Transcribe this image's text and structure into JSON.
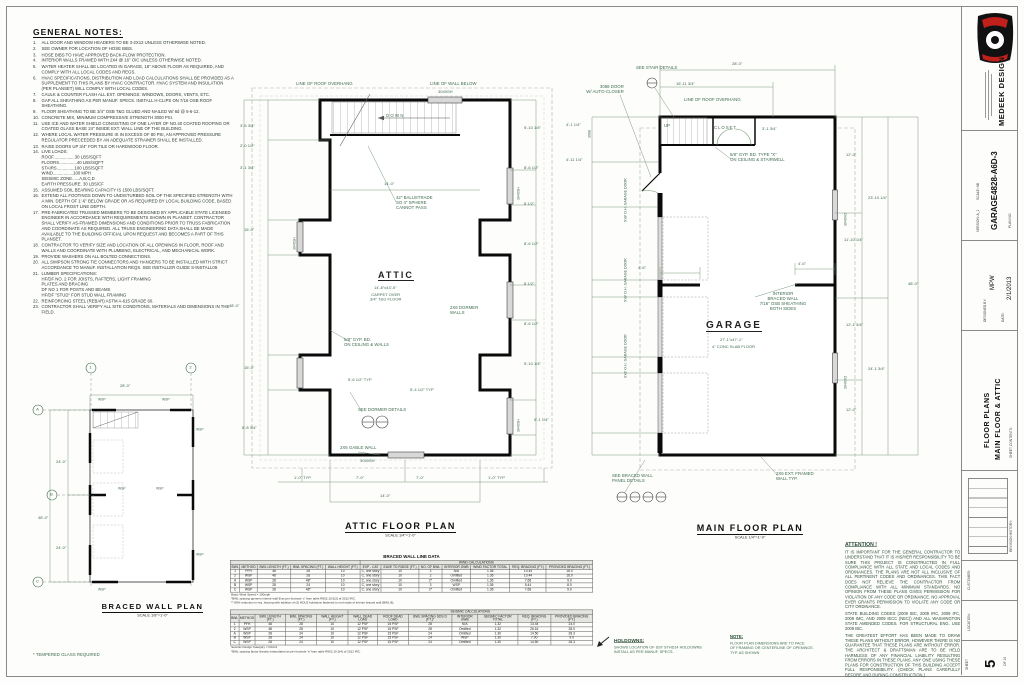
{
  "colors": {
    "annotation": "#3e6b4e",
    "wall": "#0a0a0a",
    "accent_red": "#c0201c",
    "sheet": "#fdfdfc"
  },
  "general_notes": {
    "title": "GENERAL NOTES:",
    "items": [
      {
        "n": "1.",
        "t": "ALL DOOR AND WINDOW HEADERS TO BE 3-2X12 UNLESS OTHERWISE NOTED."
      },
      {
        "n": "2.",
        "t": "SEE OWNER FOR LOCATION OF HOSE BIBS."
      },
      {
        "n": "3.",
        "t": "HOSE BIBS TO HAVE APPROVED BACK-FLOW PROTECTION."
      },
      {
        "n": "4.",
        "t": "INTERIOR WALLS FRAMED WITH 2X4 @ 16\" O/C UNLESS OTHERWISE NOTED."
      },
      {
        "n": "5.",
        "t": "WATER HEATER SHALL BE LOCATED IN GARAGE, 18\" ABOVE FLOOR AS REQUIRED, AND COMPLY WITH ALL LOCAL CODES AND REGS."
      },
      {
        "n": "6.",
        "t": "HVAC SPECIFICATIONS, DISTRIBUTION AND LOAD CALCULATIONS SHALL BE PROVIDED AS A SUPPLEMENT TO THIS PLANS BY HVAC CONTRACTOR. HVAC SYSTEM AND INSULATION (PER PLANSET) WILL COMPLY WITH LOCAL CODES."
      },
      {
        "n": "7.",
        "t": "CAULK & COUNTER FLASH ALL EXT. OPENINGS: WINDOWS, DOORS, VENTS, ETC."
      },
      {
        "n": "8.",
        "t": "GAP ALL SHEATHING AS PER MANUF. SPECS.  INSTALL H-CLIPS ON 7/16 OSB ROOF SHEATHING."
      },
      {
        "n": "9.",
        "t": "FLOOR SHEATHING TO BE 3/4\" OSB T&G GLUED AND NAILED W/ 8d @ 6-6-12."
      },
      {
        "n": "10.",
        "t": "CONCRETE MIX, MINIMUM COMPRESSIVE STRENGTH 3000 PSI."
      },
      {
        "n": "11.",
        "t": "USE ICE AND WATER SHIELD CONSISTING OF ONE LAYER OF NO.40 COATED ROOFING OR COATED GLASS BASE 24\" INSIDE EXT. WALL LINE OF THE BUILDING."
      },
      {
        "n": "12.",
        "t": "WHERE LOCAL WATER PRESSURE IS IN EXCESS OF 80 PSI, AN APPROVED PRESSURE REGULATOR PRECEEDED BY AN ADEQUATE STRAINER SHALL BE INSTALLED."
      },
      {
        "n": "13.",
        "t": "RAISE DOORS UP 3/4\" FOR TILE OR HARDWOOD FLOOR."
      },
      {
        "n": "14.",
        "t": "LIVE LOADS:\nROOF..................30 LBS/SQFT\nFLOORS...............40 LBS/SQFT\nSTAIRS...............100 LBS/SQFT\nWIND.................100 MPH\nSEISMIC ZONE......A,B,C,D\nEARTH PRESSURE. 30 LBS/CF"
      },
      {
        "n": "15.",
        "t": "ASSUMED SOIL BEARING CAPACITY IS 1500 LBS/SQFT."
      },
      {
        "n": "16.",
        "t": "EXTEND ALL FOOTINGS DOWN TO UNDISTURBED SOIL OF THE SPECIFIED STRENGTH WITH A MIN. DEPTH OF 1'-6\" BELOW GRADE OR AS REQUIRED BY LOCAL BUILDING CODE, BASED ON LOCAL FROST LINE DEPTH."
      },
      {
        "n": "17.",
        "t": "PRE-FABRICATED TRUSSED MEMBERS TO BE DESIGNED BY APPLICABLE STATE LICENSED ENGINEER IN ACCORDANCE WITH REQUIREMENTS SHOWN IN PLANSET. CONTRACTOR SHALL VERIFY AS-FRAMED DIMENSIONS AND CONDITIONS PRIOR TO TRUSS FABRICATION AND COORDINATE AS REQUIRED.  ALL TRUSS ENGINEERING DATA SHALL BE MADE AVAILABLE TO THE BUILDING OFFICIAL UPON REQUEST AND BECOMES A PART OF THIS PLANSET."
      },
      {
        "n": "18.",
        "t": "CONTRACTOR TO VERIFY SIZE AND LOCATION OF ALL OPENINGS IN FLOOR, ROOF AND WALLS AND COORDINATE WITH PLUMBING, ELECTRICAL, AND MECHANICAL WORK."
      },
      {
        "n": "19.",
        "t": "PROVIDE WASHERS ON ALL BOLTED CONNECTIONS."
      },
      {
        "n": "20.",
        "t": "ALL SIMPSON STRONG TIE CONNECTORS AND HANGERS TO BE INSTALLED WITH STRICT ACCORDANCE TO MANUF. INSTALLATION REQS. SEE INSTALLER GUIDE S-INSTALL09."
      },
      {
        "n": "21.",
        "t": "LUMBER SPECIFICATIONS:\nHF/DF NO. 2 FOR JOISTS, RAFTERS, LIGHT FRAMING\nPLATES AND BRACING\nDF NO 1 FOR POSTS AND BEAMS\nHF/DF \"STUD\" FOR STUD WALL FRAMING"
      },
      {
        "n": "22.",
        "t": "REINFORCING STEEL (REBAR) ASTM A-615 GRADE 60."
      },
      {
        "n": "23.",
        "t": "CONTRACTOR SHALL VERIFY ALL SITE CONDITIONS, MATERIALS AND DIMENSIONS IN THE FIELD."
      }
    ]
  },
  "attic": {
    "title": "ATTIC FLOOR PLAN",
    "scale": "SCALE 1/4\"=1'-0\"",
    "room": "ATTIC",
    "room_size": "14'-8\"x43'-5\"",
    "room_floor": "CARPET OVER\n3/4\" T&G FLOOR",
    "down": "DOWN",
    "balustrade": "42\" BALUSTRADE\nSO 4\" SPHERE\nCANNOT PASS",
    "roof_overhang": "LINE OF ROOF OVERHANG",
    "wall_below": "LINE OF WALL BELOW",
    "dormer_walls": "2X6 DORMER\nWALLS",
    "gyp": "5/8\" GYP. BD.\nON CEILING & WALLS",
    "gable": "2X6 GABLE WALL",
    "see_dormer": "SEE DORMER DETAILS",
    "win": "3040SH",
    "dim_top": "14'-0\"",
    "dims_left": [
      "3'-5 3/4\"",
      "2'-0 1/2\"",
      "3'-1 3/4\"",
      "15'-0\"",
      "15'-0\"",
      "8'-8 3/4\""
    ],
    "dim_left_total": "48'-0\"",
    "dims_right": [
      "5'-10 1/4\"",
      "8'-6 1/2\"",
      "8 1/2\"",
      "8'-6 1/2\"",
      "8 1/2\"",
      "8'-6 1/2\"",
      "5'-10 1/4\""
    ],
    "dim_right_extra": "5'-1 1/4\"",
    "typ1": "5'-6 1/2\" TYP",
    "typ2": "5'-4 1/2\" TYP",
    "dims_bottom": [
      "1'-0\" TYP",
      "7'-0\"",
      "7'-0\"",
      "1'-0\" TYP"
    ],
    "dim_bottom_total": "14'-0\""
  },
  "main": {
    "title": "MAIN FLOOR PLAN",
    "scale": "SCALE 1/4\"=1'-0\"",
    "room": "GARAGE",
    "room_size": "27'-1\"x47'-1\"",
    "room_floor": "4\" CONC SLAB FLOOR",
    "up": "UP",
    "closet": "CLOSET",
    "door": "3068 DOOR\nW/ AUTO-CLOSER",
    "door_tag": "3068",
    "see_stair": "SEE STAIR DETAILS",
    "roof_overhang": "LINE OF ROOF OVERHANG",
    "gyp": "5/8\" GYP. BD. TYPE \"X\"\nON CEILING & STAIRWELL",
    "braced": "INTERIOR\nBRACED WALL\n7/16\" OSB SHEATHING\nBOTH SIDES",
    "garage_door": "9'x8' O.H. GARAGE DOOR",
    "ext_wall": "2X6 EXT. FRAMED\nWALL TYP.",
    "see_braced": "SEE BRACED WALL\nPANEL DETAILS",
    "win": "3040XO",
    "dim_top": "28'-0\"",
    "dim_top2": "16'-11 3/4\"",
    "dim_closet": "3'-1 3/4\"",
    "dim_stub": "4'-6\"",
    "dims_left": [
      "4'-1 1/4\"",
      "4'-11 1/4\""
    ],
    "dims_right": [
      "12'-0\"",
      "23'-10 1/4\"",
      "11'-10 1/4\"",
      "48'-0\"",
      "12'-1 3/4\"",
      "24'-1 3/4\"",
      "12'-0\""
    ]
  },
  "braced": {
    "title": "BRACED WALL PLAN",
    "scale": "SCALE 1/8\"=1'-0\"",
    "footnote": "* TEMPERED GLASS REQUIRED",
    "grid_cols": [
      "1",
      "2"
    ],
    "grid_rows": [
      "A",
      "B",
      "C"
    ],
    "dim_top": "28'-0\"",
    "dims_left": [
      "24'-0\"",
      "24'-0\""
    ],
    "dim_left_total": "48'-0\"",
    "wsp": "WSP"
  },
  "tables": {
    "title": "BRACED WALL LINE DATA",
    "wind": {
      "header": "WIND CALCULATIONS",
      "columns": [
        "BWL",
        "METHOD",
        "BWL LENGTH (FT.)",
        "BWL SPACING (FT.)",
        "WALL HEIGHT (FT.)",
        "EXP - CAT",
        "EAVE TO RIDGE (FT.)",
        "NO. OF BWL",
        "INTERIOR GWB",
        "WIND FACTOR TOTAL",
        "REQ. BRACING (FT.)",
        "PROVIDED BRACING (FT.)"
      ],
      "rows": [
        [
          "1",
          "PFH",
          "48",
          "28",
          "10",
          "C, one story",
          "10",
          "2",
          "N/A",
          "1.36",
          "10.44",
          "16.0"
        ],
        [
          "2",
          "WSP",
          "48",
          "28",
          "10",
          "C, one story",
          "10",
          "2",
          "Omitted",
          "1.36",
          "10.44",
          "16.0"
        ],
        [
          "A",
          "WSP",
          "28",
          "48*",
          "10",
          "C, one story",
          "10",
          "2*",
          "Omitted",
          "1.36",
          "7.68",
          "9.0"
        ],
        [
          "B",
          "WSP",
          "28",
          "24",
          "10",
          "C, one story",
          "10",
          "3",
          "WSP",
          "1.36",
          "5.44",
          "8.0"
        ],
        [
          "C",
          "WSP",
          "28",
          "48*",
          "10",
          "C, one story",
          "10",
          "2*",
          "Omitted",
          "1.36",
          "7.68",
          "9.0"
        ]
      ],
      "footnotes": [
        "Basic Wind Speed = 100mph",
        "*BWL spacing governs interior wall B as per footnote 'c' from table R602.10.5(2) of 2012 IRC.",
        "** 80% reduction in req. bracing with addition of (2) HDU2 holdowns fastened to end studs of interior braced wall (BWL B)."
      ]
    },
    "seismic": {
      "header": "SEISMIC CALCULATIONS",
      "columns": [
        "BWL",
        "METHOD",
        "BWL LENGTH (FT.)",
        "BWL SPACING (FT.)",
        "WALL HEIGHT (FT.)",
        "WALL DEAD LOAD",
        "ROOF DEAD LOAD",
        "BWL SPACING SDS D (FT.)*",
        "INTERIOR GWB",
        "SEISMIC FACTOR TOTAL",
        "REQ. BRACING (FT.)",
        "PROVIDED BRACING (FT.)"
      ],
      "rows": [
        [
          "1",
          "PFH",
          "48",
          "28",
          "10",
          "12 PSF",
          "15 PSF",
          "28",
          "N/A",
          "1.32",
          "13.44",
          "24.0"
        ],
        [
          "2",
          "WSP",
          "48",
          "28",
          "10",
          "12 PSF",
          "15 PSF",
          "28",
          "Omitted",
          "1.32",
          "26.16",
          "28.0"
        ],
        [
          "A",
          "WSP",
          "28",
          "24",
          "10",
          "12 PSF",
          "15 PSF",
          "24",
          "Omitted",
          "1.30",
          "14.50",
          "28.3"
        ],
        [
          "B",
          "WSP",
          "28",
          "24",
          "10",
          "12 PSF",
          "15 PSF",
          "24",
          "WSP",
          "1.30",
          "7.00",
          "9.0"
        ],
        [
          "C",
          "WSP",
          "28",
          "24",
          "10",
          "12 PSF",
          "15 PSF",
          "24",
          "Omitted",
          "1.30",
          "14.50",
          "28.3"
        ]
      ],
      "footnotes": [
        "Seismic Design Category = D0-D1",
        "*BWL spacing factor linearly interpolated as per footnote 'a' from table R602.10.3(4) of 2012 IRC."
      ]
    }
  },
  "holdowns": {
    "title": "HOLDOWNS:",
    "text": "SHOWS LOCATION OF SST STHD14 HOLDOWNS\nINSTALL AS PER MANUF. SPECS."
  },
  "note": {
    "title": "NOTE:",
    "text": "FLOOR PLAN DIMENSIONS ARE TO FACE\nOF FRAMING OR CENTERLINE OF OPENINGS\nTYP. AS SHOWN"
  },
  "attention": {
    "title": "ATTENTION !",
    "p1": "IT IS IMPORTANT FOR THE GENERAL CONTRACTOR TO UNDERSTAND THAT IT IS HIS/HER RESPONSIBILITY TO BE SURE THIS PROJECT IS CONSTRUCTED IN FULL COMPLIANCE WITH ALL STATE AND LOCAL CODES AND ORDINANCES. THE PLANS ARE NOT ALL INCLUSIVE OF ALL PERTINENT CODES AND ORDINANCES. THIS FACT DOES NOT RELIEVE THE CONTRACTOR FROM COMPLIANCE WITH ALL MINIMUM STANDARDS. NO OPINION FROM THESE PLANS GIVES PERMISSION FOR VIOLATION OF ANY CODE OR ORDINANCE. NO APPROVAL EVER GRANTS PERMISSION TO VIOLATE ANY CODE OR CITY ORDINANCE.",
    "p2": "STATE BUILDING CODES (2009 IBC, 2009 IRC, 2009 IFC, 2009 IMC, AND 2009 IECC (NEC)) AND ALL WASHINGTON STATE AMENDED CODES. FOR STRUCTURAL ENG. USE 2009 IBC.",
    "p3": "THE GREATEST EFFORT HAS BEEN MADE TO DRAW THESE PLANS WITHOUT ERROR, HOWEVER THERE IS NO GUARANTEE THAT THESE PLANS ARE WITHOUT ERROR. THE ARCHITECT & DRAFTSMAN ARE TO BE HELD HARMLESS OF ANY FINANCIAL LIABILITY RESULTING FROM ERRORS IN THESE PLANS. ANY ONE USING THESE PLANS FOR CONSTRUCTION OF THIS BUILDING ACCEPT FULL RESPONSIBILITY. (CHECK PLANS CAREFULLY BEFORE AND DURING CONSTRUCTION.)"
  },
  "titleblock": {
    "brand": "MEDEEK DESIGN",
    "plan_no_label": "PLAN NO.",
    "plan_no": "GARAGE4828-A6D-3",
    "scale_label": "SCALE:  NB",
    "version_label": "VERSION:  A_1",
    "designed_label": "DESIGNED BY:",
    "designed": "MPW",
    "date_label": "DATE:",
    "date": "2/1/2013",
    "contents_label": "SHEET CONTENTS:",
    "contents1": "FLOOR PLANS",
    "contents2": "MAIN FLOOR & ATTIC",
    "revision_label": "REVISION HISTORY:",
    "customer_label": "CUSTOMER:",
    "location_label": "LOCATION:",
    "sheet_label": "SHEET",
    "sheet_no": "5",
    "of_label": "OF  10"
  }
}
